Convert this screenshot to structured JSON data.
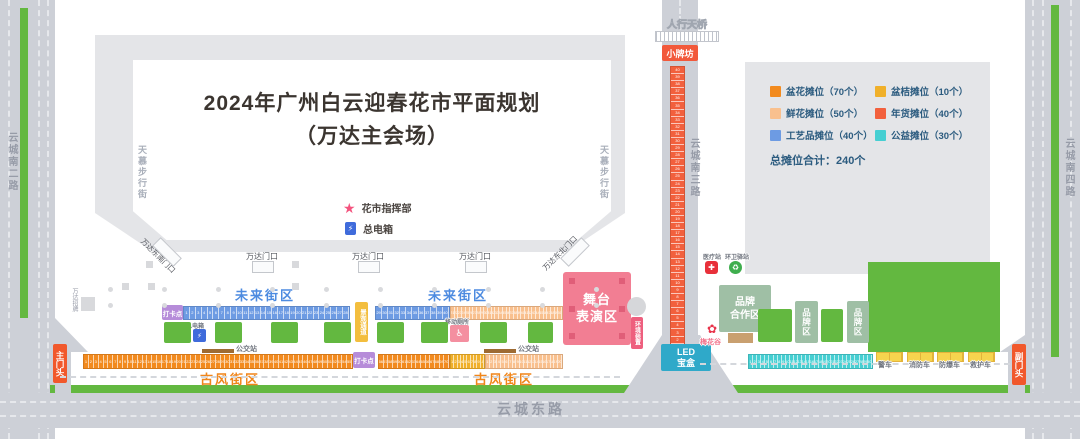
{
  "title": {
    "line1": "2024年广州白云迎春花市平面规划",
    "line2": "（万达主会场）"
  },
  "legend": {
    "items": [
      {
        "label": "盆花摊位（70个）",
        "type": "potted"
      },
      {
        "label": "盆桔摊位（10个）",
        "type": "kumquat"
      },
      {
        "label": "鲜花摊位（50个）",
        "type": "fresh"
      },
      {
        "label": "年货摊位（40个）",
        "type": "goods"
      },
      {
        "label": "工艺品摊位（40个）",
        "type": "craft"
      },
      {
        "label": "公益摊位（30个）",
        "type": "charity"
      }
    ],
    "total": "总摊位合计：240个"
  },
  "labels": {
    "pedestrian_bridge": "人行天桥",
    "archway": "小牌坊",
    "road_left": "云城南二路",
    "road_middle": "云城南三路",
    "road_right": "云城南四路",
    "road_bottom": "云城东路",
    "canopy_street": "天慕步行街",
    "command_post": "花市指挥部",
    "main_power": "总电箱",
    "gate_se": "万达东南门口",
    "gate_ne": "万达东北门口",
    "gate_main": "万达门口",
    "wanda_sign": "万达招牌",
    "future_zone": "未来街区",
    "ancient_zone": "古风街区",
    "checkin": "打卡点",
    "landscape_passage": "景观通道",
    "bus_stop": "公交站",
    "stage_line1": "舞台",
    "stage_line2": "表演区",
    "installation": "环境装置",
    "led_line1": "LED",
    "led_line2": "宝盒",
    "brand_coop_line1": "品牌",
    "brand_coop_line2": "合作区",
    "brand_zone": "品牌区",
    "medical": "医疗站",
    "sanitation": "环卫驿站",
    "toilet": "移动厕所",
    "plum": "梅花谷",
    "gate_front_main": "主门头",
    "gate_front_sub": "副门头"
  },
  "vehicles": [
    "警车",
    "消防车",
    "防爆车",
    "救护车"
  ],
  "strips": {
    "craft_a": {
      "type": "craft",
      "from": 1,
      "to": 28
    },
    "craft_b": {
      "type": "craft",
      "from": 29,
      "to": 40
    },
    "fresh_top": {
      "type": "fresh",
      "from": 21,
      "to": 50
    },
    "potted_a": {
      "type": "potted",
      "from": 1,
      "to": 55
    },
    "potted_b": {
      "type": "potted",
      "from": 56,
      "to": 70
    },
    "kumquat_a": {
      "type": "kumquat",
      "from": 1,
      "to": 10
    },
    "fresh_bottom": {
      "type": "fresh",
      "from": 1,
      "to": 20
    },
    "goods_v": {
      "type": "goods",
      "from": 1,
      "to": 40,
      "reverse": true
    },
    "charity_a": {
      "type": "charity",
      "from": 1,
      "to": 30
    }
  },
  "colors": {
    "stall": {
      "potted": "#F28A1E",
      "kumquat": "#F0B02A",
      "fresh": "#F9C08E",
      "goods": "#F2603D",
      "craft": "#6D9BE3",
      "charity": "#46CFD2"
    },
    "road": "#CDD0D7",
    "green": "#63B840",
    "stage_pink": "#F27E93",
    "sage": "#9FBFA5",
    "purple": "#B68CD9",
    "led_teal": "#2FA9C9",
    "gate_red": "#F1582B",
    "legend_text": "#2B5B7F"
  }
}
